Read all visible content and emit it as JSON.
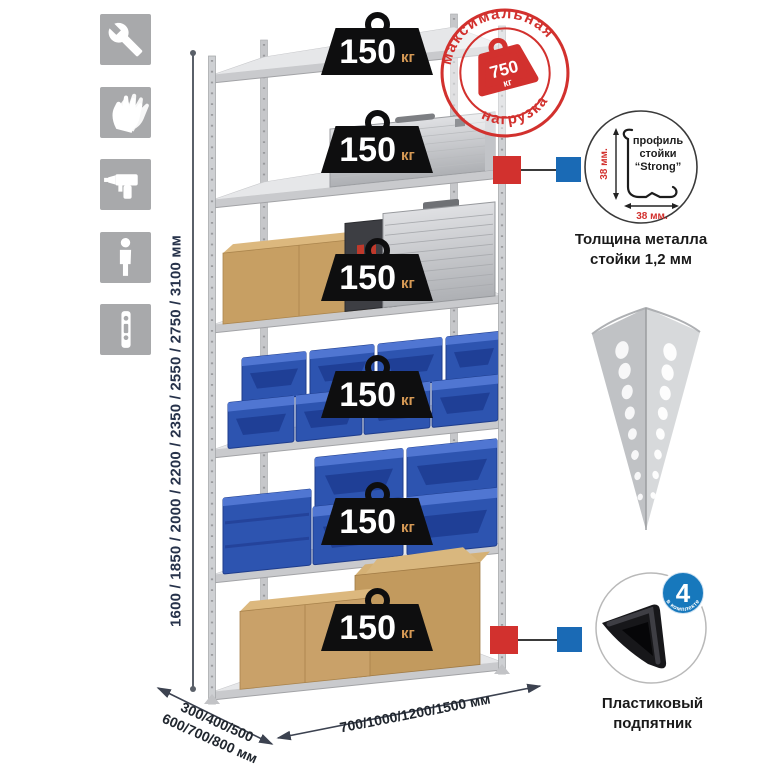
{
  "assembly_icons": {
    "items": [
      {
        "name": "wrench-icon"
      },
      {
        "name": "gloves-icon"
      },
      {
        "name": "drill-icon"
      },
      {
        "name": "person-icon"
      },
      {
        "name": "post-profile-icon"
      }
    ]
  },
  "dimensions": {
    "height_label": "1600 / 1850 / 2000 / 2200 / 2350 / 2550 / 2750 / 3100 мм",
    "depth_line1": "300/400/500",
    "depth_line2": "600/700/800 мм",
    "width_label": "700/1000/1200/1500 мм"
  },
  "shelf_load": {
    "value": "150",
    "unit": "кг",
    "shelf_count": 6
  },
  "max_load_stamp": {
    "arc_top": "максимальная",
    "arc_bottom": "нагрузка",
    "value": "750",
    "unit": "кг"
  },
  "post_profile_detail": {
    "label_line1": "профиль",
    "label_line2": "стойки",
    "label_line3": "“Strong”",
    "vertical_dim": "38 мм.",
    "horizontal_dim": "38 мм.",
    "caption_line1": "Толщина металла",
    "caption_line2": "стойки 1,2 мм"
  },
  "foot_detail": {
    "badge_count": "4",
    "badge_caption": "в комплекте",
    "caption_line1": "Пластиковый",
    "caption_line2": "подпятник"
  },
  "colors": {
    "accent_red": "#d2312e",
    "accent_blue": "#1a6ab5",
    "badge_black": "#0e0e0f",
    "badge_unit_orange": "#d79a55",
    "metal_gray": "#cdced1",
    "bin_blue": "#2d54b0",
    "cardboard": "#c9a169",
    "icon_gray": "#a8a9ab"
  }
}
